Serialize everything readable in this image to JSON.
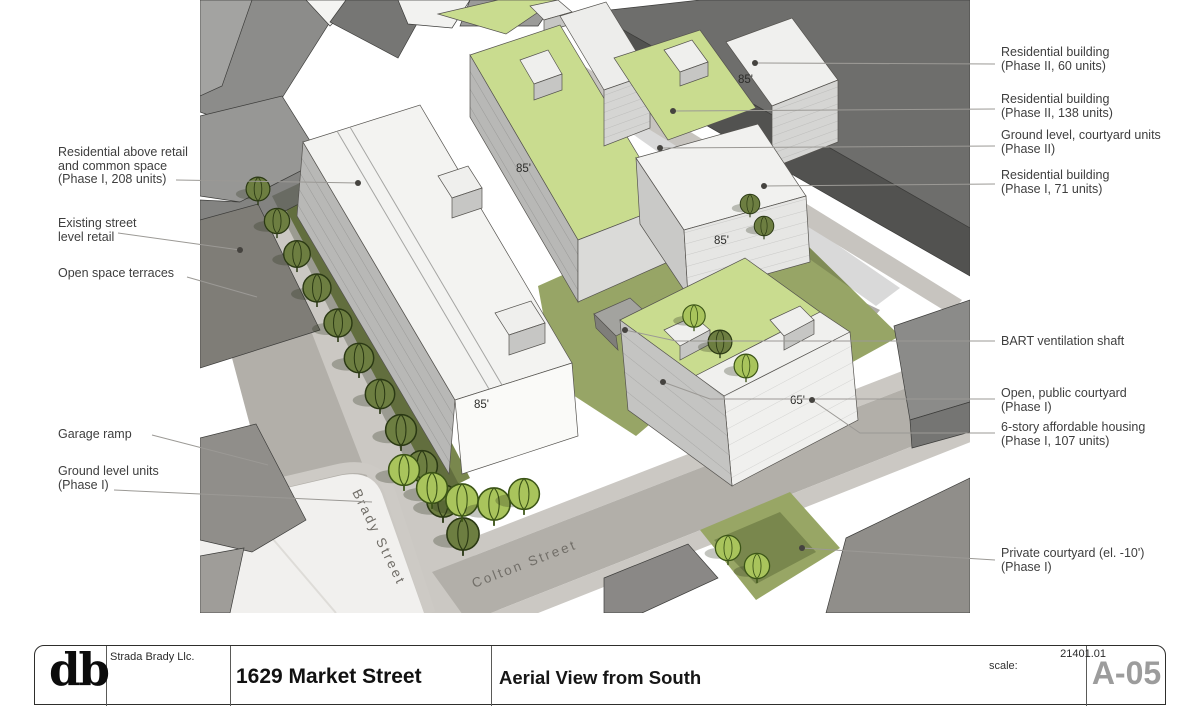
{
  "titleblock": {
    "logo_text": "db",
    "client": "Strada Brady Llc.",
    "project_title": "1629 Market Street",
    "sheet_title": "Aerial View from South",
    "project_number": "21401.01",
    "scale_label": "scale:",
    "sheet_number": "A-05"
  },
  "scene": {
    "street_labels": {
      "brady": "Brady Street",
      "colton": "Colton Street"
    },
    "height_labels": [
      {
        "building": "phase-1-208-unit-bar",
        "text": "85'"
      },
      {
        "building": "phase-2-138-unit-bar",
        "text": "85'"
      },
      {
        "building": "phase-2-60-unit-tower",
        "text": "85'"
      },
      {
        "building": "phase-1-71-unit-building",
        "text": "85'"
      },
      {
        "building": "6-story-affordable",
        "text": "65'"
      }
    ]
  },
  "callouts": {
    "left": [
      {
        "lines": [
          "Residential above retail",
          "and common space",
          "(Phase I, 208 units)"
        ]
      },
      {
        "lines": [
          "Existing street",
          "level retail"
        ]
      },
      {
        "lines": [
          "Open space terraces"
        ]
      },
      {
        "lines": [
          "Garage ramp"
        ]
      },
      {
        "lines": [
          "Ground level units",
          "(Phase I)"
        ]
      }
    ],
    "right": [
      {
        "lines": [
          "Residential building",
          "(Phase II, 60 units)"
        ]
      },
      {
        "lines": [
          "Residential building",
          "(Phase II, 138 units)"
        ]
      },
      {
        "lines": [
          "Ground level, courtyard units",
          "(Phase II)"
        ]
      },
      {
        "lines": [
          "Residential building",
          "(Phase I, 71 units)"
        ]
      },
      {
        "lines": [
          "BART ventilation shaft"
        ]
      },
      {
        "lines": [
          "Open, public courtyard",
          "(Phase I)"
        ]
      },
      {
        "lines": [
          "6-story affordable housing",
          "(Phase I, 107 units)"
        ]
      },
      {
        "lines": [
          "Private courtyard (el. -10')",
          "(Phase I)"
        ]
      }
    ]
  },
  "colors": {
    "green_roof": "#c9dc8f",
    "courtyard_green": "#97a566",
    "tree_dark": "#6d7e41",
    "tree_light": "#a9c45c",
    "street_gray": "#b2afa9",
    "sidewalk_gray": "#cbc8c3",
    "context_dark": "#525250",
    "building_white": "#f3f3f1",
    "leader_gray": "#9b9995",
    "label_text": "#3e3e3e"
  }
}
